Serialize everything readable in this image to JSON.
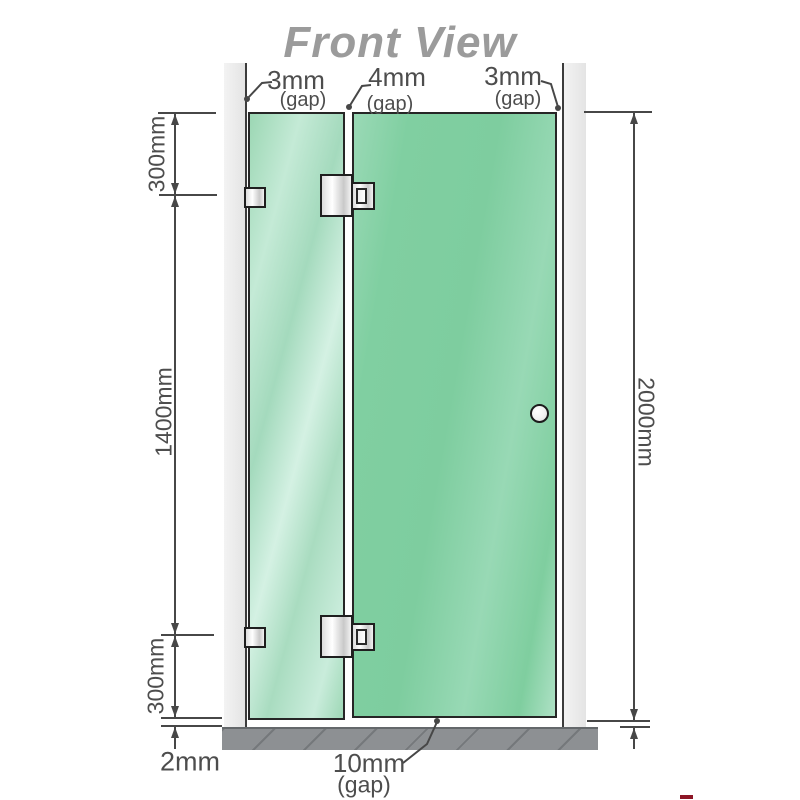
{
  "title": "Front View",
  "palette": {
    "glass_green": "#7ecd9f",
    "glass_highlight": "#d4f1e3",
    "wall_gray": "#e9e9e9",
    "base_gray": "#8d9093",
    "line_color": "#474747",
    "label_color": "#4d4d4d",
    "title_color": "#9b9b9b"
  },
  "top_gap_labels": {
    "left": {
      "value": "3mm",
      "note": "(gap)"
    },
    "middle": {
      "value": "4mm",
      "note": "(gap)"
    },
    "right": {
      "value": "3mm",
      "note": "(gap)"
    }
  },
  "side_dimensions": {
    "left_top": "300mm",
    "left_middle": "1400mm",
    "left_bottom": "300mm",
    "right_height": "2000mm"
  },
  "bottom_labels": {
    "base_offset": "2mm",
    "floor_gap": {
      "value": "10mm",
      "note": "(gap)"
    }
  }
}
